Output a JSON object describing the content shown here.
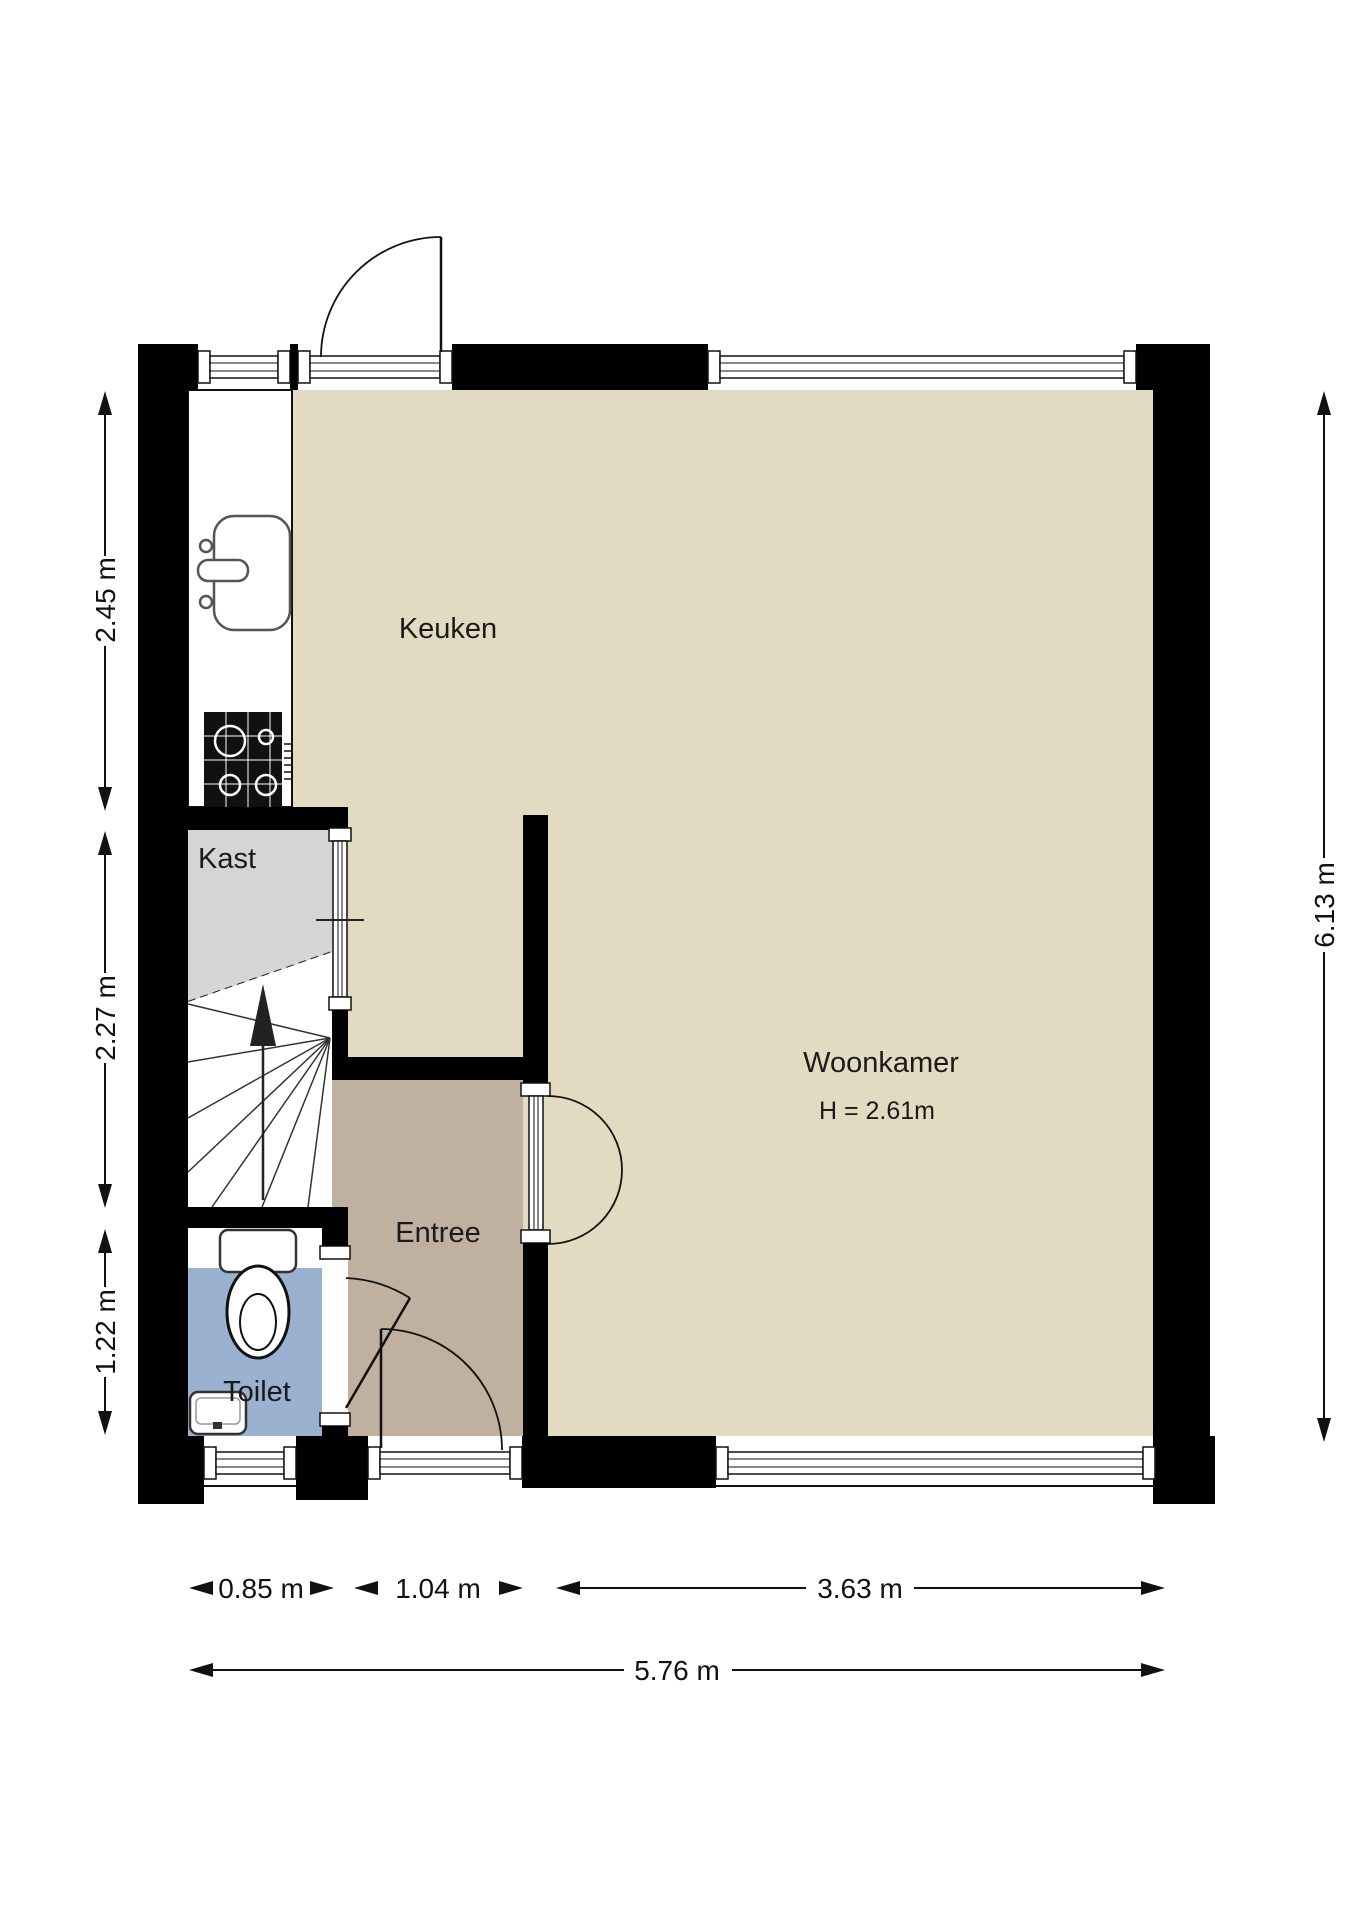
{
  "rooms": {
    "keuken": {
      "label": "Keuken",
      "floor_color": "#E3DBC1"
    },
    "woonkamer": {
      "label": "Woonkamer",
      "ceiling_height": "H = 2.61m",
      "floor_color": "#E3DBC1"
    },
    "entree": {
      "label": "Entree",
      "floor_color": "#BFB0A0"
    },
    "kast": {
      "label": "Kast",
      "floor_color": "#D5D5D5"
    },
    "toilet": {
      "label": "Toilet",
      "floor_color": "#9BB1D0"
    }
  },
  "dimensions": {
    "left_top": "2.45 m",
    "left_middle": "2.27 m",
    "left_bottom": "1.22 m",
    "right_total": "6.13 m",
    "bottom_toilet": "0.85 m",
    "bottom_entree": "1.04 m",
    "bottom_woonkamer": "3.63 m",
    "bottom_total": "5.76 m"
  },
  "colors": {
    "wall": "#000000",
    "line": "#1a1a1a",
    "fixture_outline": "#555555"
  }
}
